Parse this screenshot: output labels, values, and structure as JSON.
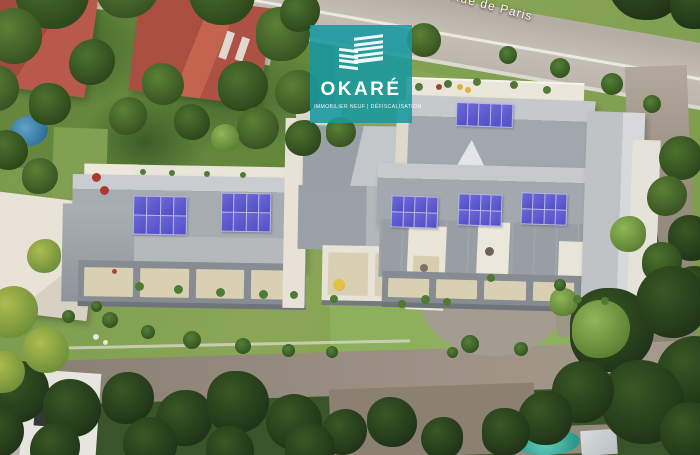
{
  "logo": {
    "brand": "OKARÉ",
    "tagline": "IMMOBILIER NEUF | DÉFISCALISATION",
    "icon": "stacked-building-icon"
  },
  "map": {
    "street_label": "Rue de Paris",
    "view": "aerial-photo"
  },
  "colors": {
    "logo_teal": "#1798a1",
    "solar_panel_blue": "#504ec2",
    "solar_grid_line": "#b9b9e2",
    "roof_gray": "#a3a9ae",
    "roof_gray_light": "#c6cacd",
    "terrace_white": "#eae6da",
    "terrace_floor_beige": "#d9d0b5",
    "lawn_green": "#87a355",
    "tree_dark_green": "#33501f",
    "road_asphalt": "#c0bab1",
    "driveway_brown": "#9a8f82",
    "red_roof": "#b05449",
    "pool_turquoise": "#41b4a8"
  },
  "scene": {
    "solar_array_count": 6,
    "red_roof_houses": 2,
    "pools": 2
  }
}
